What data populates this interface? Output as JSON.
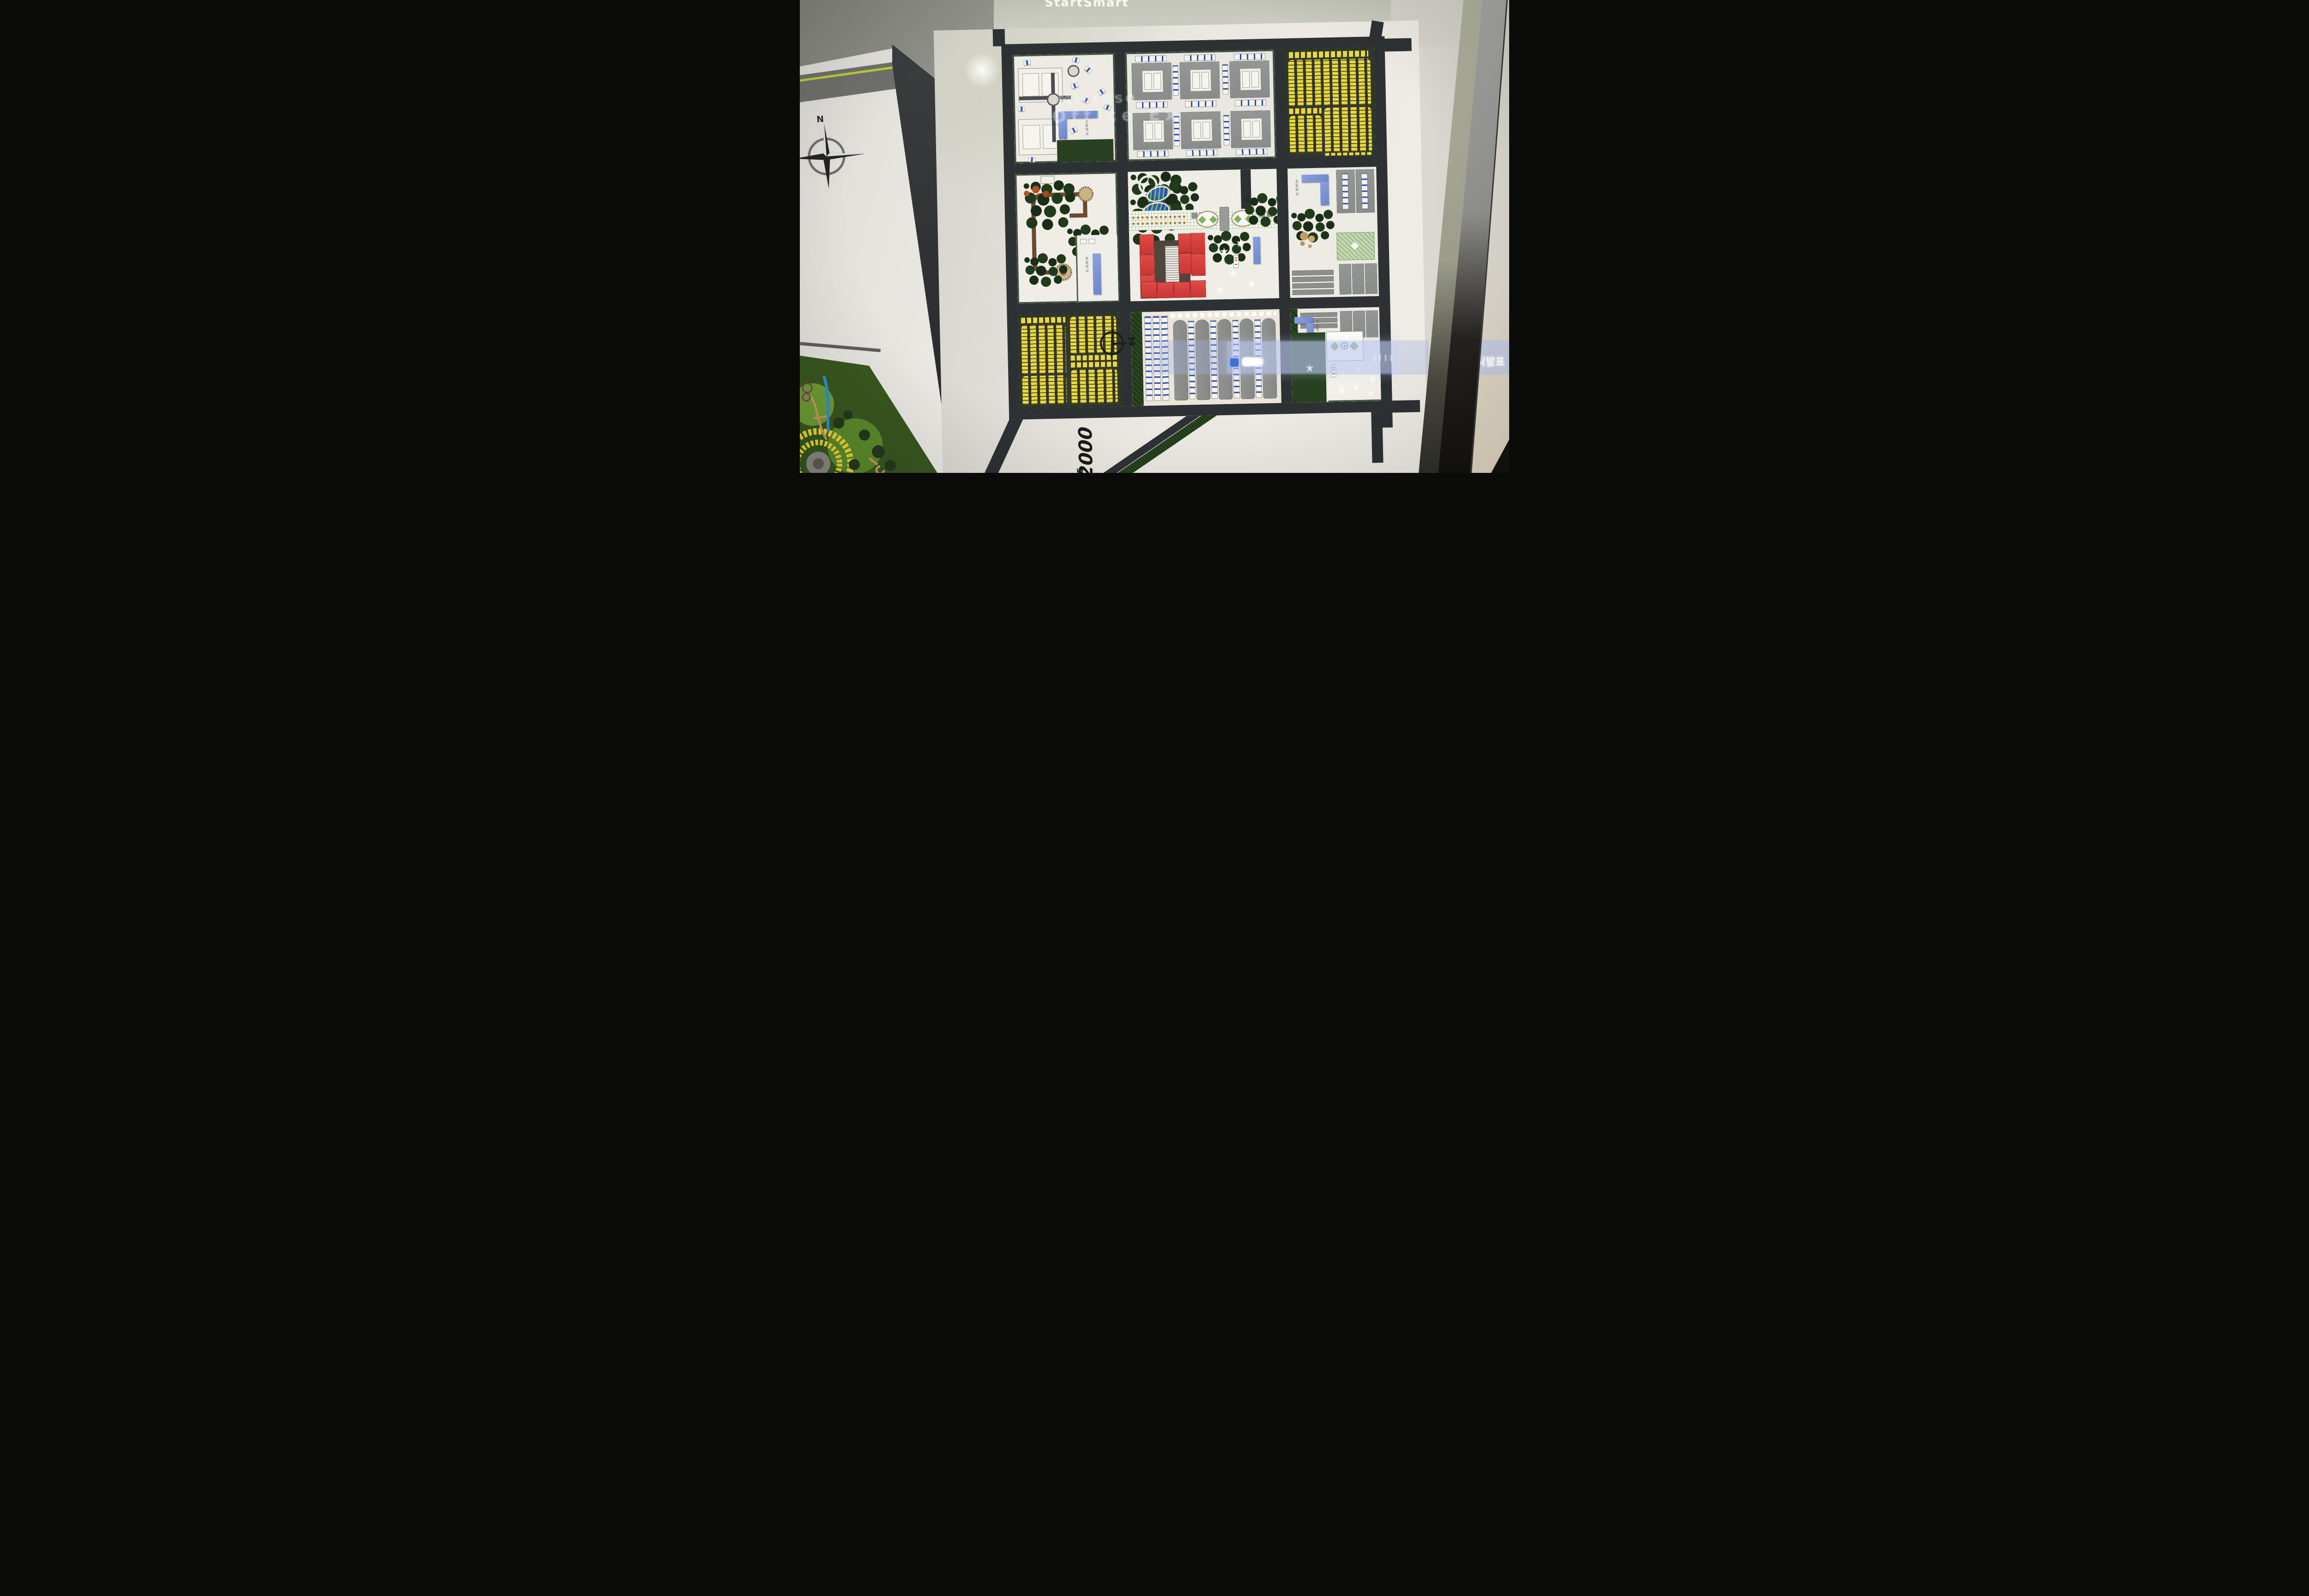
{
  "projection": {
    "screen_title": "StartSmart",
    "ghost_text_line1": "Microso",
    "ghost_text_line2": "Office Ex",
    "banner": {
      "right_text": "시발표"
    }
  },
  "model_board": {
    "scale_number": "1:2000",
    "scale_word": "SCALE",
    "north_mark_letter": "z",
    "school_label": "초등학교"
  },
  "side_board": {
    "compass_label": "N"
  },
  "colors": {
    "road_tape": "#2e3134",
    "hedge_green": "#24391f",
    "tree_green": "#1d2f1b",
    "rowhouse_yellow": "#e8d93e",
    "slab_gray": "#8e9090",
    "accent_blue": "#2c49ae",
    "building_blue": "#7b93d6",
    "commercial_red": "#d8413f",
    "pond_blue": "#2b57a8",
    "banner_blue": "#aab8e6"
  }
}
